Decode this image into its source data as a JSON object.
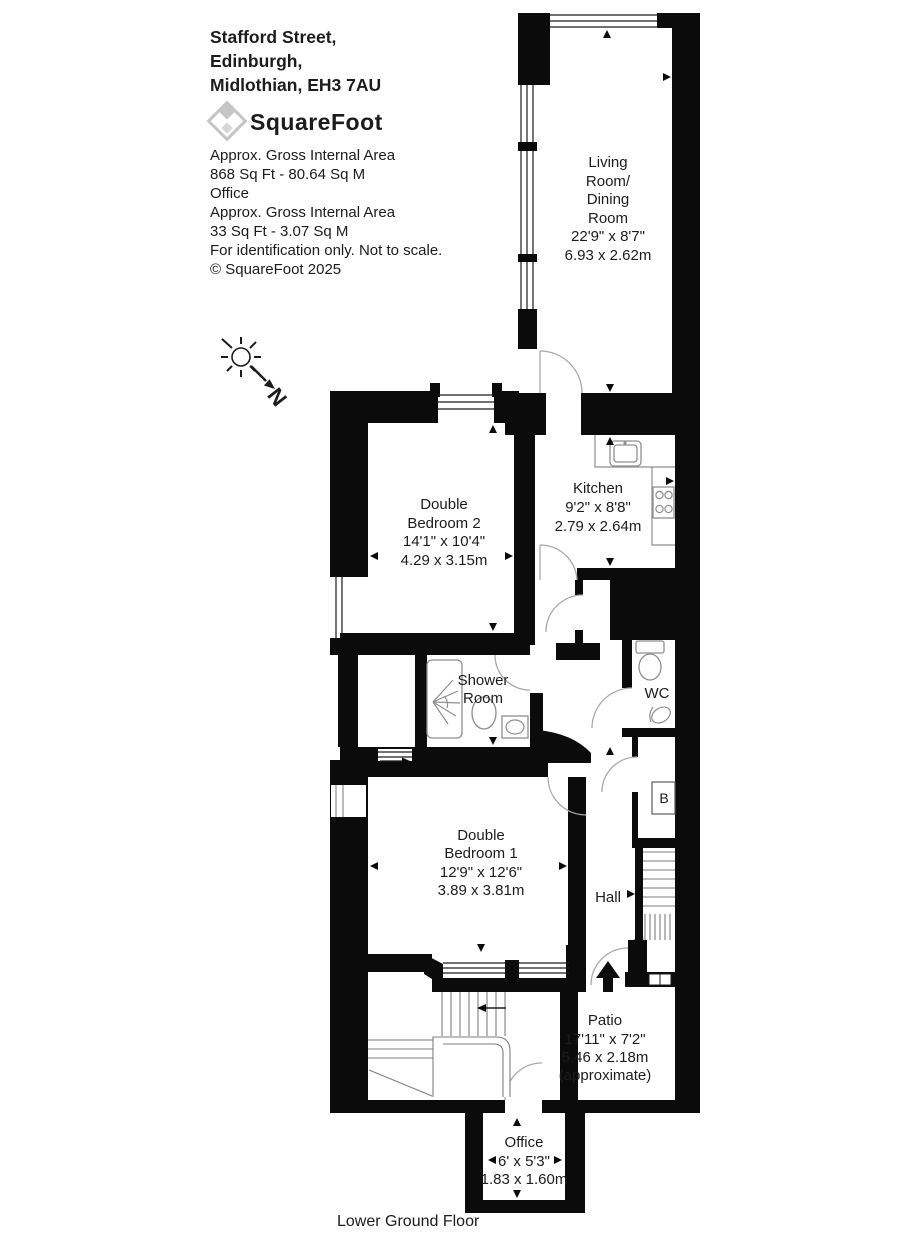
{
  "header": {
    "address_lines": [
      "Stafford Street,",
      "Edinburgh,",
      "Midlothian, EH3 7AU"
    ],
    "logo_text": "SquareFoot",
    "info_lines": [
      "Approx. Gross Internal Area",
      "868 Sq Ft  -  80.64 Sq M",
      "Office",
      "Approx. Gross Internal Area",
      "33 Sq Ft  -  3.07 Sq M",
      "For identification only. Not to scale.",
      "© SquareFoot 2025"
    ]
  },
  "compass": {
    "north_label": "N"
  },
  "floor_label": "Lower Ground Floor",
  "rooms": {
    "living_dining": {
      "lines": [
        "Living",
        "Room/",
        "Dining",
        "Room",
        "22'9\" x 8'7\"",
        "6.93 x 2.62m"
      ]
    },
    "kitchen": {
      "lines": [
        "Kitchen",
        "9'2\" x 8'8\"",
        "2.79 x 2.64m"
      ]
    },
    "bedroom2": {
      "lines": [
        "Double",
        "Bedroom 2",
        "14'1\" x 10'4\"",
        "4.29 x 3.15m"
      ]
    },
    "shower": {
      "lines": [
        "Shower",
        "Room"
      ]
    },
    "wc": {
      "label": "WC"
    },
    "boiler": {
      "label": "B"
    },
    "bedroom1": {
      "lines": [
        "Double",
        "Bedroom 1",
        "12'9\" x 12'6\"",
        "3.89 x 3.81m"
      ]
    },
    "hall": {
      "label": "Hall"
    },
    "patio": {
      "lines": [
        "Patio",
        "17'11\" x 7'2\"",
        "5.46 x 2.18m",
        "(approximate)"
      ]
    },
    "office": {
      "lines": [
        "Office",
        "6' x 5'3\"",
        "1.83 x 1.60m"
      ]
    }
  },
  "colors": {
    "wall": "#0b0b0b",
    "text": "#1c1c1c",
    "logo_gray": "#c8c8c8",
    "fixture_gray": "#8f8f8f",
    "background": "#ffffff"
  }
}
